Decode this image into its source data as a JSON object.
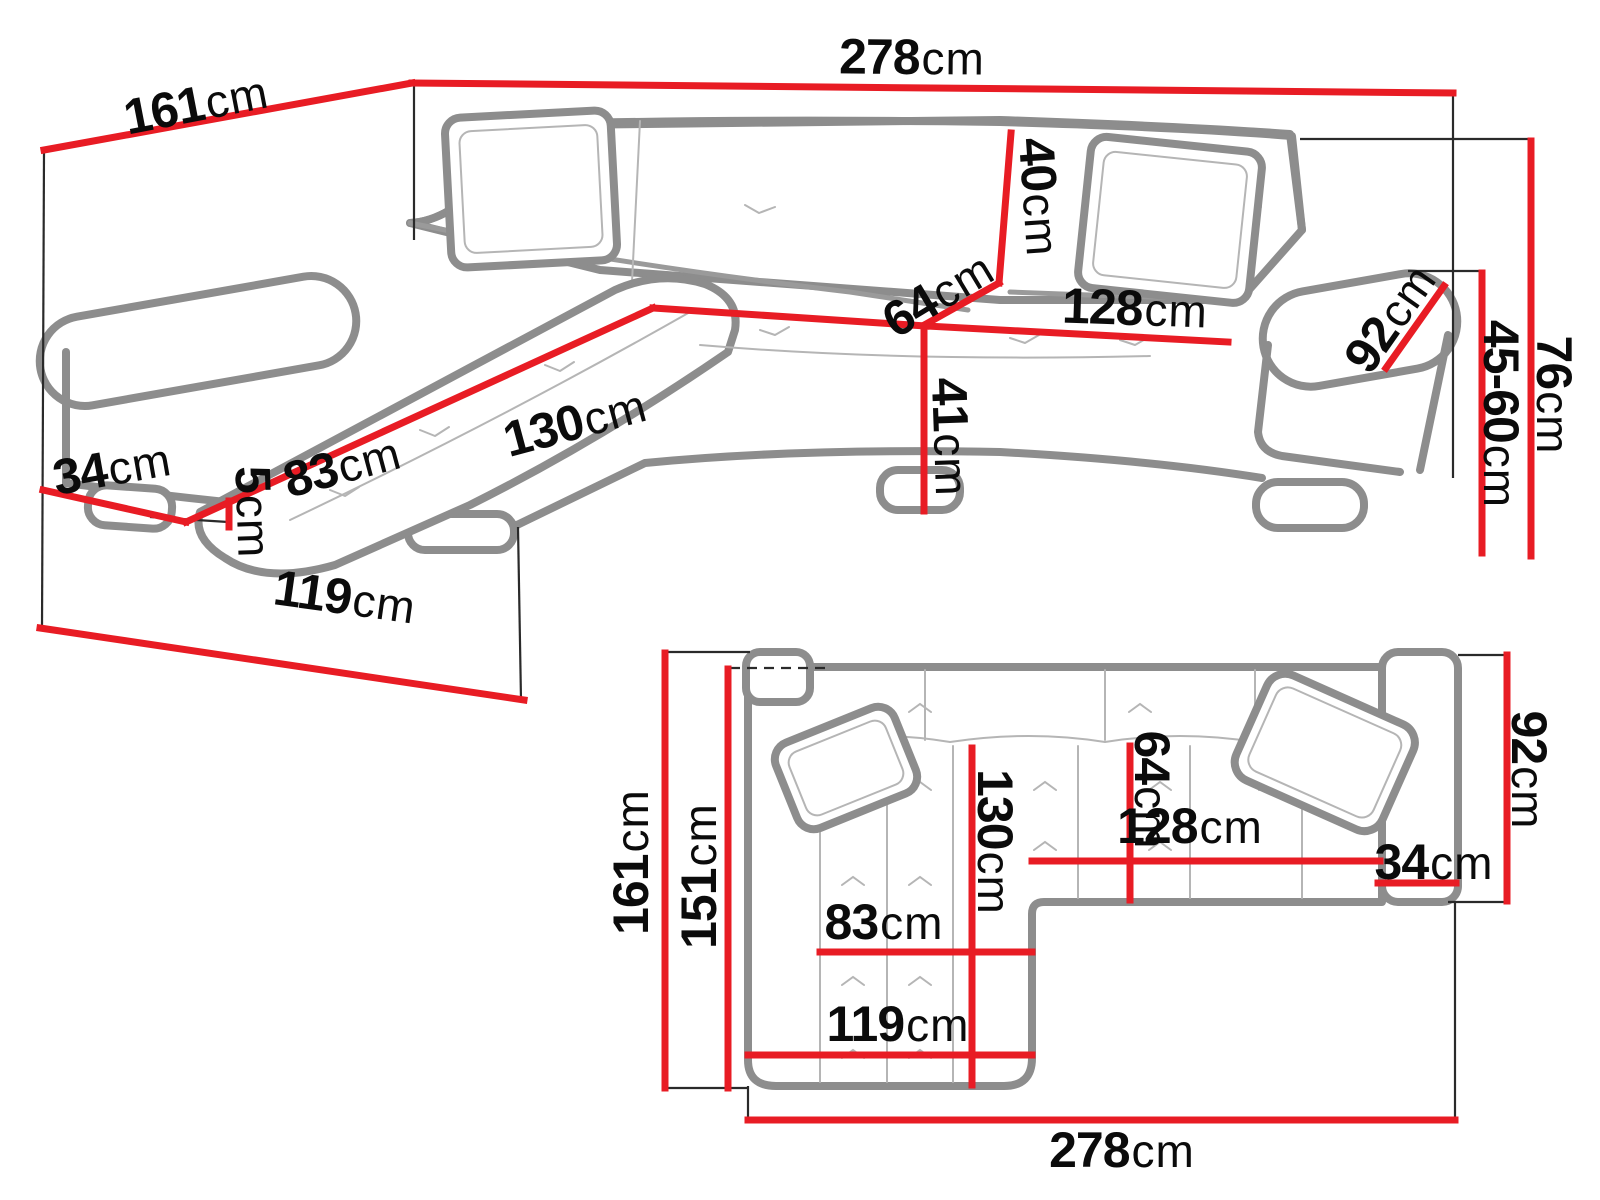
{
  "colors": {
    "dimension_line": "#e81c24",
    "sofa_outline": "#8d8d8d",
    "sofa_detail": "#b5b5b5",
    "connector_line": "#2a2a2a",
    "label_text": "#0b0b0b",
    "background": "#ffffff"
  },
  "views": {
    "perspective": {
      "dimensions": [
        {
          "id": "total-width",
          "value": "278",
          "unit": "cm"
        },
        {
          "id": "total-depth",
          "value": "161",
          "unit": "cm"
        },
        {
          "id": "armrest-width",
          "value": "34",
          "unit": "cm"
        },
        {
          "id": "chaise-seat-width",
          "value": "83",
          "unit": "cm"
        },
        {
          "id": "chaise-seat-length",
          "value": "130",
          "unit": "cm"
        },
        {
          "id": "seat-depth",
          "value": "64",
          "unit": "cm"
        },
        {
          "id": "backrest-height",
          "value": "40",
          "unit": "cm"
        },
        {
          "id": "seat-width",
          "value": "128",
          "unit": "cm"
        },
        {
          "id": "armrest-length",
          "value": "92",
          "unit": "cm"
        },
        {
          "id": "seat-front-height",
          "value": "41",
          "unit": "cm"
        },
        {
          "id": "leg-height",
          "value": "5",
          "unit": "cm"
        },
        {
          "id": "seat-height-range",
          "value": "45-60",
          "unit": "cm"
        },
        {
          "id": "total-height",
          "value": "76",
          "unit": "cm"
        },
        {
          "id": "chaise-front-width",
          "value": "119",
          "unit": "cm"
        }
      ]
    },
    "plan": {
      "dimensions": [
        {
          "id": "total-depth",
          "value": "161",
          "unit": "cm"
        },
        {
          "id": "inner-depth",
          "value": "151",
          "unit": "cm"
        },
        {
          "id": "chaise-seat-length",
          "value": "130",
          "unit": "cm"
        },
        {
          "id": "seat-depth",
          "value": "64",
          "unit": "cm"
        },
        {
          "id": "seat-width",
          "value": "128",
          "unit": "cm"
        },
        {
          "id": "armrest-width",
          "value": "34",
          "unit": "cm"
        },
        {
          "id": "sofa-depth",
          "value": "92",
          "unit": "cm"
        },
        {
          "id": "chaise-seat-width",
          "value": "83",
          "unit": "cm"
        },
        {
          "id": "chaise-width",
          "value": "119",
          "unit": "cm"
        },
        {
          "id": "total-width",
          "value": "278",
          "unit": "cm"
        }
      ]
    }
  }
}
